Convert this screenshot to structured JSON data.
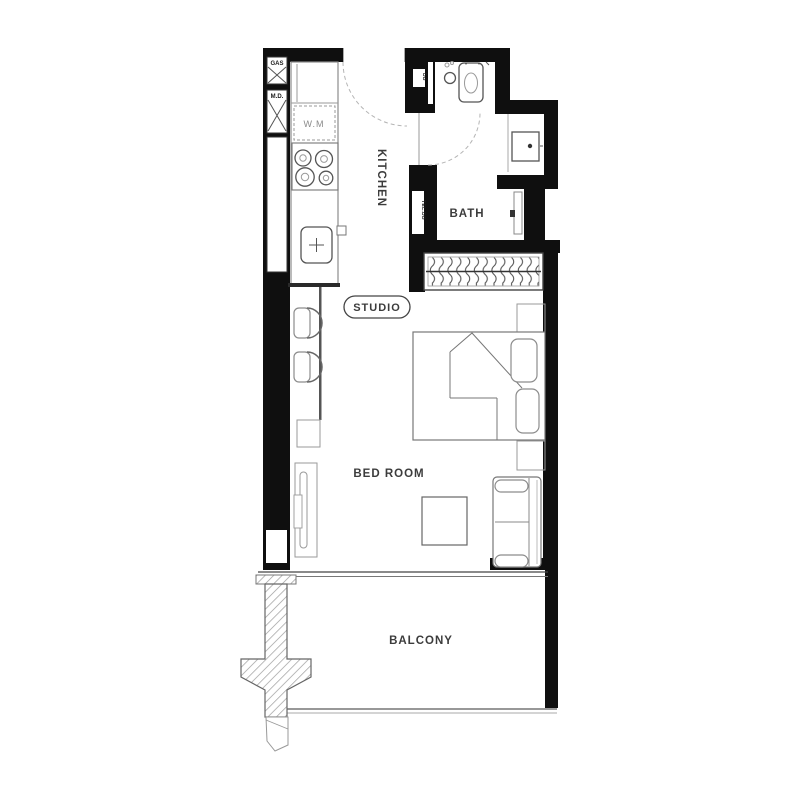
{
  "plan_type": "studio-apartment-floor-plan",
  "labels": {
    "kitchen": "KITCHEN",
    "bath": "BATH",
    "studio": "STUDIO",
    "bedroom": "BED ROOM",
    "balcony": "BALCONY",
    "gas": "GAS",
    "meter_md": "M.D.",
    "washing_machine": "W.M",
    "db": "DB",
    "tel_db": "TEL.DB"
  },
  "colors": {
    "wall": "#0f0f0f",
    "furniture_line": "#8c8c8c",
    "dark_line": "#555555",
    "label_text": "#3c3c3c",
    "background": "#ffffff"
  }
}
